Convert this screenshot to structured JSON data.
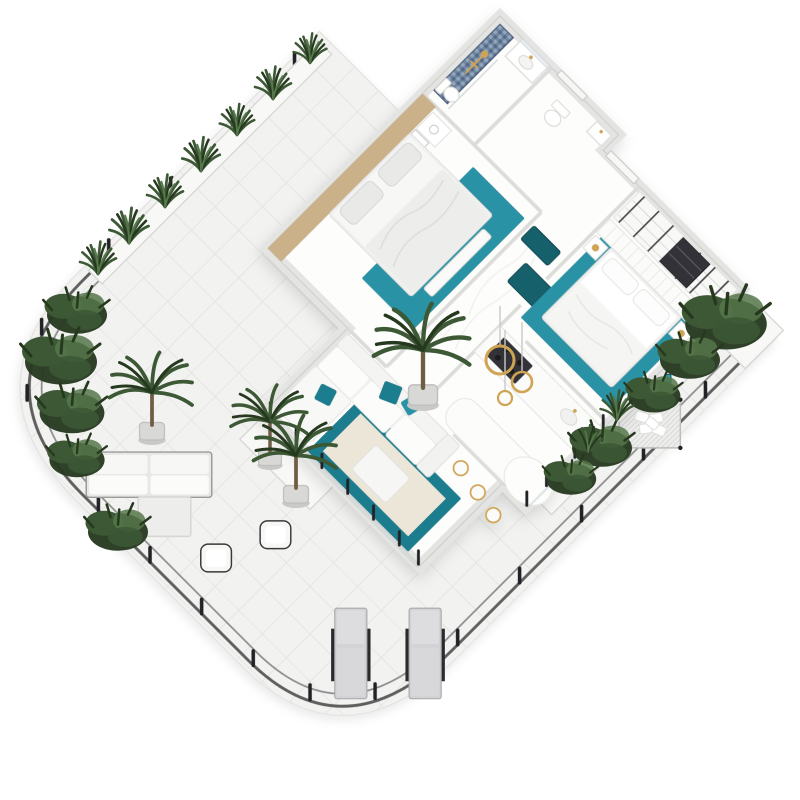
{
  "scene": {
    "label": "3D isometric render of a two-bedroom apartment floor plan with wrap-around tiled terrace",
    "style": "white and teal interior with brass-gold accents",
    "rooms": [
      {
        "name": "bathroom",
        "items": [
          "blue-mosaic-shower-wall",
          "gold-shower-fixture",
          "vanity-sink",
          "mirror",
          "toilet"
        ]
      },
      {
        "name": "wc",
        "items": [
          "toilet",
          "hand-basin",
          "door"
        ]
      },
      {
        "name": "hallway",
        "items": [
          "teal-ottoman",
          "teal-ottoman"
        ]
      },
      {
        "name": "main-bedroom",
        "items": [
          "open-wardrobe",
          "dark-cabinet",
          "channel-headboard",
          "double-bed",
          "teal-rug",
          "gold-table-lamp",
          "gold-table-lamp",
          "nightstand",
          "nightstand"
        ]
      },
      {
        "name": "second-bedroom",
        "items": [
          "wood-feature-wall",
          "framed-artwork",
          "framed-artwork",
          "double-bed",
          "teal-rug",
          "foot-bench",
          "nightstand",
          "table-lamp"
        ]
      },
      {
        "name": "kitchen",
        "items": [
          "counter-with-cooktop",
          "breakfast-bar",
          "oval-bar-end",
          "bar-stool",
          "bar-stool",
          "bar-stool",
          "bar-stool",
          "gold-ring-pendant",
          "gold-ring-pendant",
          "gold-ring-pendant"
        ]
      },
      {
        "name": "living-room",
        "items": [
          "corner-sofa",
          "teal-cushion",
          "teal-cushion",
          "teal-cushion",
          "teal-border-rug",
          "white-ottoman",
          "glass-balustrade"
        ]
      }
    ],
    "terrace": {
      "floor": "light-grey-diagonal-tiles",
      "railing": "dark-double-rail-with-posts",
      "items": [
        "sun-lounger",
        "sun-lounger",
        "outdoor-sofa",
        "outdoor-chair",
        "outdoor-chair",
        "coffee-table",
        "hanging-net-daybed-with-pillows",
        "teal-cube-table",
        "planter-row",
        "palm-plant",
        "palm-plant",
        "palm-plant",
        "shrub-planters"
      ]
    },
    "counts": {
      "bedrooms": 2,
      "bathrooms": 2,
      "sun_loungers": 2,
      "bar_stools": 4,
      "pendant_rings": 3,
      "teal_ottomans": 2
    }
  },
  "colors": {
    "teal": "#2a92a5",
    "tealDeep": "#1f7d8e",
    "tealDark": "#17606c",
    "tealBright": "#2fa9bd",
    "gold": "#cfa452",
    "goldSoft": "#dfc27e",
    "wood": "#cbb189",
    "mosaicA": "#70879f",
    "mosaicB": "#93a7bd",
    "mosaicC": "#54688a",
    "wall": "#e4e4e2",
    "wallEdge": "#cdcdcb",
    "floor": "#fdfdfc",
    "tile": "#f2f2f0",
    "tileLine": "#e1e1df",
    "railDark": "#5f5f61",
    "railLight": "#8e8e90",
    "post": "#212125",
    "plantDark": "#26391f",
    "plant": "#3c5835",
    "plantLight": "#56774a",
    "trunk": "#6e5c44",
    "cream": "#ece6d9",
    "fabric": "#f7f7f5",
    "fabricShade": "#e9e9e7",
    "loungerPad": "#d3d3d5",
    "frameDark": "#2b2b2d",
    "glass": "#c9d4d6",
    "marble": "#efefec",
    "applianceDark": "#323237",
    "background": "#ffffff"
  }
}
